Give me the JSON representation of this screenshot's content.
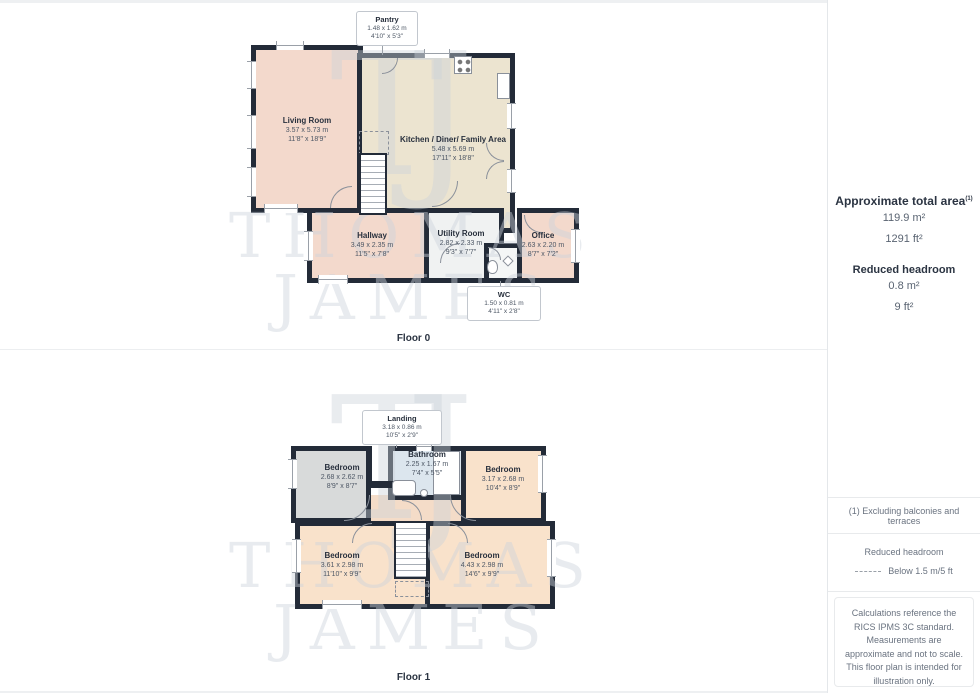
{
  "watermark": {
    "monogram": "TJ",
    "line1": "THOMAS",
    "line2": "JAMES"
  },
  "colors": {
    "wall": "#232b38",
    "room_pink": "#f3d9cc",
    "room_cream": "#ece4d0",
    "room_gray": "#d8dada",
    "room_peach": "#f9e2cb",
    "room_blue": "#dce6ee",
    "room_light": "#f0f2f2",
    "landing_peach": "#f4dcc8",
    "text_dark": "#2b3442"
  },
  "floor0": {
    "label": "Floor 0",
    "rooms": {
      "pantry": {
        "name": "Pantry",
        "m": "1.48 x 1.62 m",
        "ft": "4'10\" x 5'3\""
      },
      "living": {
        "name": "Living Room",
        "m": "3.57 x 5.73 m",
        "ft": "11'8\" x 18'9\""
      },
      "kitchen": {
        "name": "Kitchen / Diner/ Family Area",
        "m": "5.48 x 5.69 m",
        "ft": "17'11\" x 18'8\""
      },
      "hallway": {
        "name": "Hallway",
        "m": "3.49 x 2.35 m",
        "ft": "11'5\" x 7'8\""
      },
      "utility": {
        "name": "Utility Room",
        "m": "2.82 x 2.33 m",
        "ft": "9'3\" x 7'7\""
      },
      "office": {
        "name": "Office",
        "m": "2.63 x 2.20 m",
        "ft": "8'7\" x 7'2\""
      },
      "wc": {
        "name": "WC",
        "m": "1.50 x 0.81 m",
        "ft": "4'11\" x 2'8\""
      }
    }
  },
  "floor1": {
    "label": "Floor 1",
    "rooms": {
      "landing": {
        "name": "Landing",
        "m": "3.18 x 0.86 m",
        "ft": "10'5\" x 2'9\""
      },
      "bathroom": {
        "name": "Bathroom",
        "m": "2.25 x 1.67 m",
        "ft": "7'4\" x 5'5\""
      },
      "bedroom_tl": {
        "name": "Bedroom",
        "m": "2.68 x 2.62 m",
        "ft": "8'9\" x 8'7\""
      },
      "bedroom_tr": {
        "name": "Bedroom",
        "m": "3.17 x 2.68 m",
        "ft": "10'4\" x 8'9\""
      },
      "bedroom_bl": {
        "name": "Bedroom",
        "m": "3.61 x 2.98 m",
        "ft": "11'10\" x 9'9\""
      },
      "bedroom_br": {
        "name": "Bedroom",
        "m": "4.43 x 2.98 m",
        "ft": "14'6\" x 9'9\""
      }
    }
  },
  "sidebar": {
    "total_area_title": "Approximate total area",
    "total_area_sup": "(1)",
    "total_area_m": "119.9 m²",
    "total_area_ft": "1291 ft²",
    "reduced_title": "Reduced headroom",
    "reduced_m": "0.8 m²",
    "reduced_ft": "9 ft²",
    "note": "(1) Excluding balconies and terraces",
    "legend_title": "Reduced headroom",
    "legend_text": "Below 1.5 m/5 ft",
    "disclaimer": "Calculations reference the RICS IPMS 3C standard. Measurements are approximate and not to scale. This floor plan is intended for illustration only.",
    "brand_name": "GIRAFFE",
    "brand_number": "360"
  }
}
